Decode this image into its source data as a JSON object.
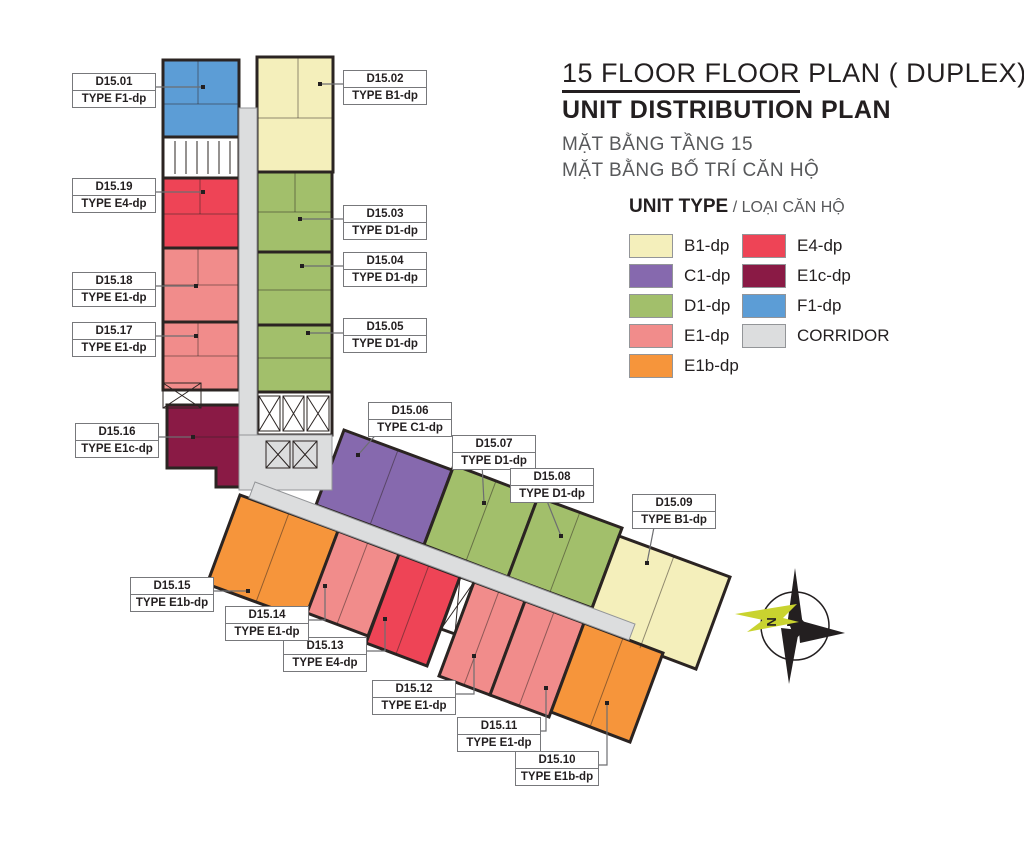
{
  "title": {
    "line1_underlined": "15 FLOOR FLOOR",
    "line1_rest": " PLAN ( DUPLEX)",
    "line2": "UNIT DISTRIBUTION PLAN",
    "subtitle1": "MẶT BẰNG TẦNG 15",
    "subtitle2": "MẶT BẰNG BỐ TRÍ CĂN HỘ"
  },
  "legend": {
    "title": "UNIT TYPE",
    "title_vn": "/ LOẠI CĂN HỘ",
    "items": [
      {
        "id": "b1",
        "label": "B1-dp",
        "color": "#F4EFBB"
      },
      {
        "id": "c1",
        "label": "C1-dp",
        "color": "#8669AE"
      },
      {
        "id": "d1",
        "label": "D1-dp",
        "color": "#A2BF6B"
      },
      {
        "id": "e1",
        "label": "E1-dp",
        "color": "#F18C8B"
      },
      {
        "id": "e1b",
        "label": "E1b-dp",
        "color": "#F6953B"
      },
      {
        "id": "e4",
        "label": "E4-dp",
        "color": "#EE4456"
      },
      {
        "id": "e1c",
        "label": "E1c-dp",
        "color": "#8A1A45"
      },
      {
        "id": "f1",
        "label": "F1-dp",
        "color": "#5C9DD6"
      },
      {
        "id": "corridor",
        "label": "CORRIDOR",
        "color": "#DCDDDE"
      }
    ]
  },
  "units": [
    {
      "code": "D15.01",
      "type_label": "TYPE F1-dp"
    },
    {
      "code": "D15.02",
      "type_label": "TYPE B1-dp"
    },
    {
      "code": "D15.03",
      "type_label": "TYPE D1-dp"
    },
    {
      "code": "D15.04",
      "type_label": "TYPE D1-dp"
    },
    {
      "code": "D15.05",
      "type_label": "TYPE D1-dp"
    },
    {
      "code": "D15.06",
      "type_label": "TYPE C1-dp"
    },
    {
      "code": "D15.07",
      "type_label": "TYPE D1-dp"
    },
    {
      "code": "D15.08",
      "type_label": "TYPE D1-dp"
    },
    {
      "code": "D15.09",
      "type_label": "TYPE B1-dp"
    },
    {
      "code": "D15.10",
      "type_label": "TYPE E1b-dp"
    },
    {
      "code": "D15.11",
      "type_label": "TYPE E1-dp"
    },
    {
      "code": "D15.12",
      "type_label": "TYPE E1-dp"
    },
    {
      "code": "D15.13",
      "type_label": "TYPE E4-dp"
    },
    {
      "code": "D15.14",
      "type_label": "TYPE E1-dp"
    },
    {
      "code": "D15.15",
      "type_label": "TYPE E1b-dp"
    },
    {
      "code": "D15.16",
      "type_label": "TYPE E1c-dp"
    },
    {
      "code": "D15.17",
      "type_label": "TYPE E1-dp"
    },
    {
      "code": "D15.18",
      "type_label": "TYPE E1-dp"
    },
    {
      "code": "D15.19",
      "type_label": "TYPE E4-dp"
    }
  ],
  "compass": {
    "label": "N"
  }
}
